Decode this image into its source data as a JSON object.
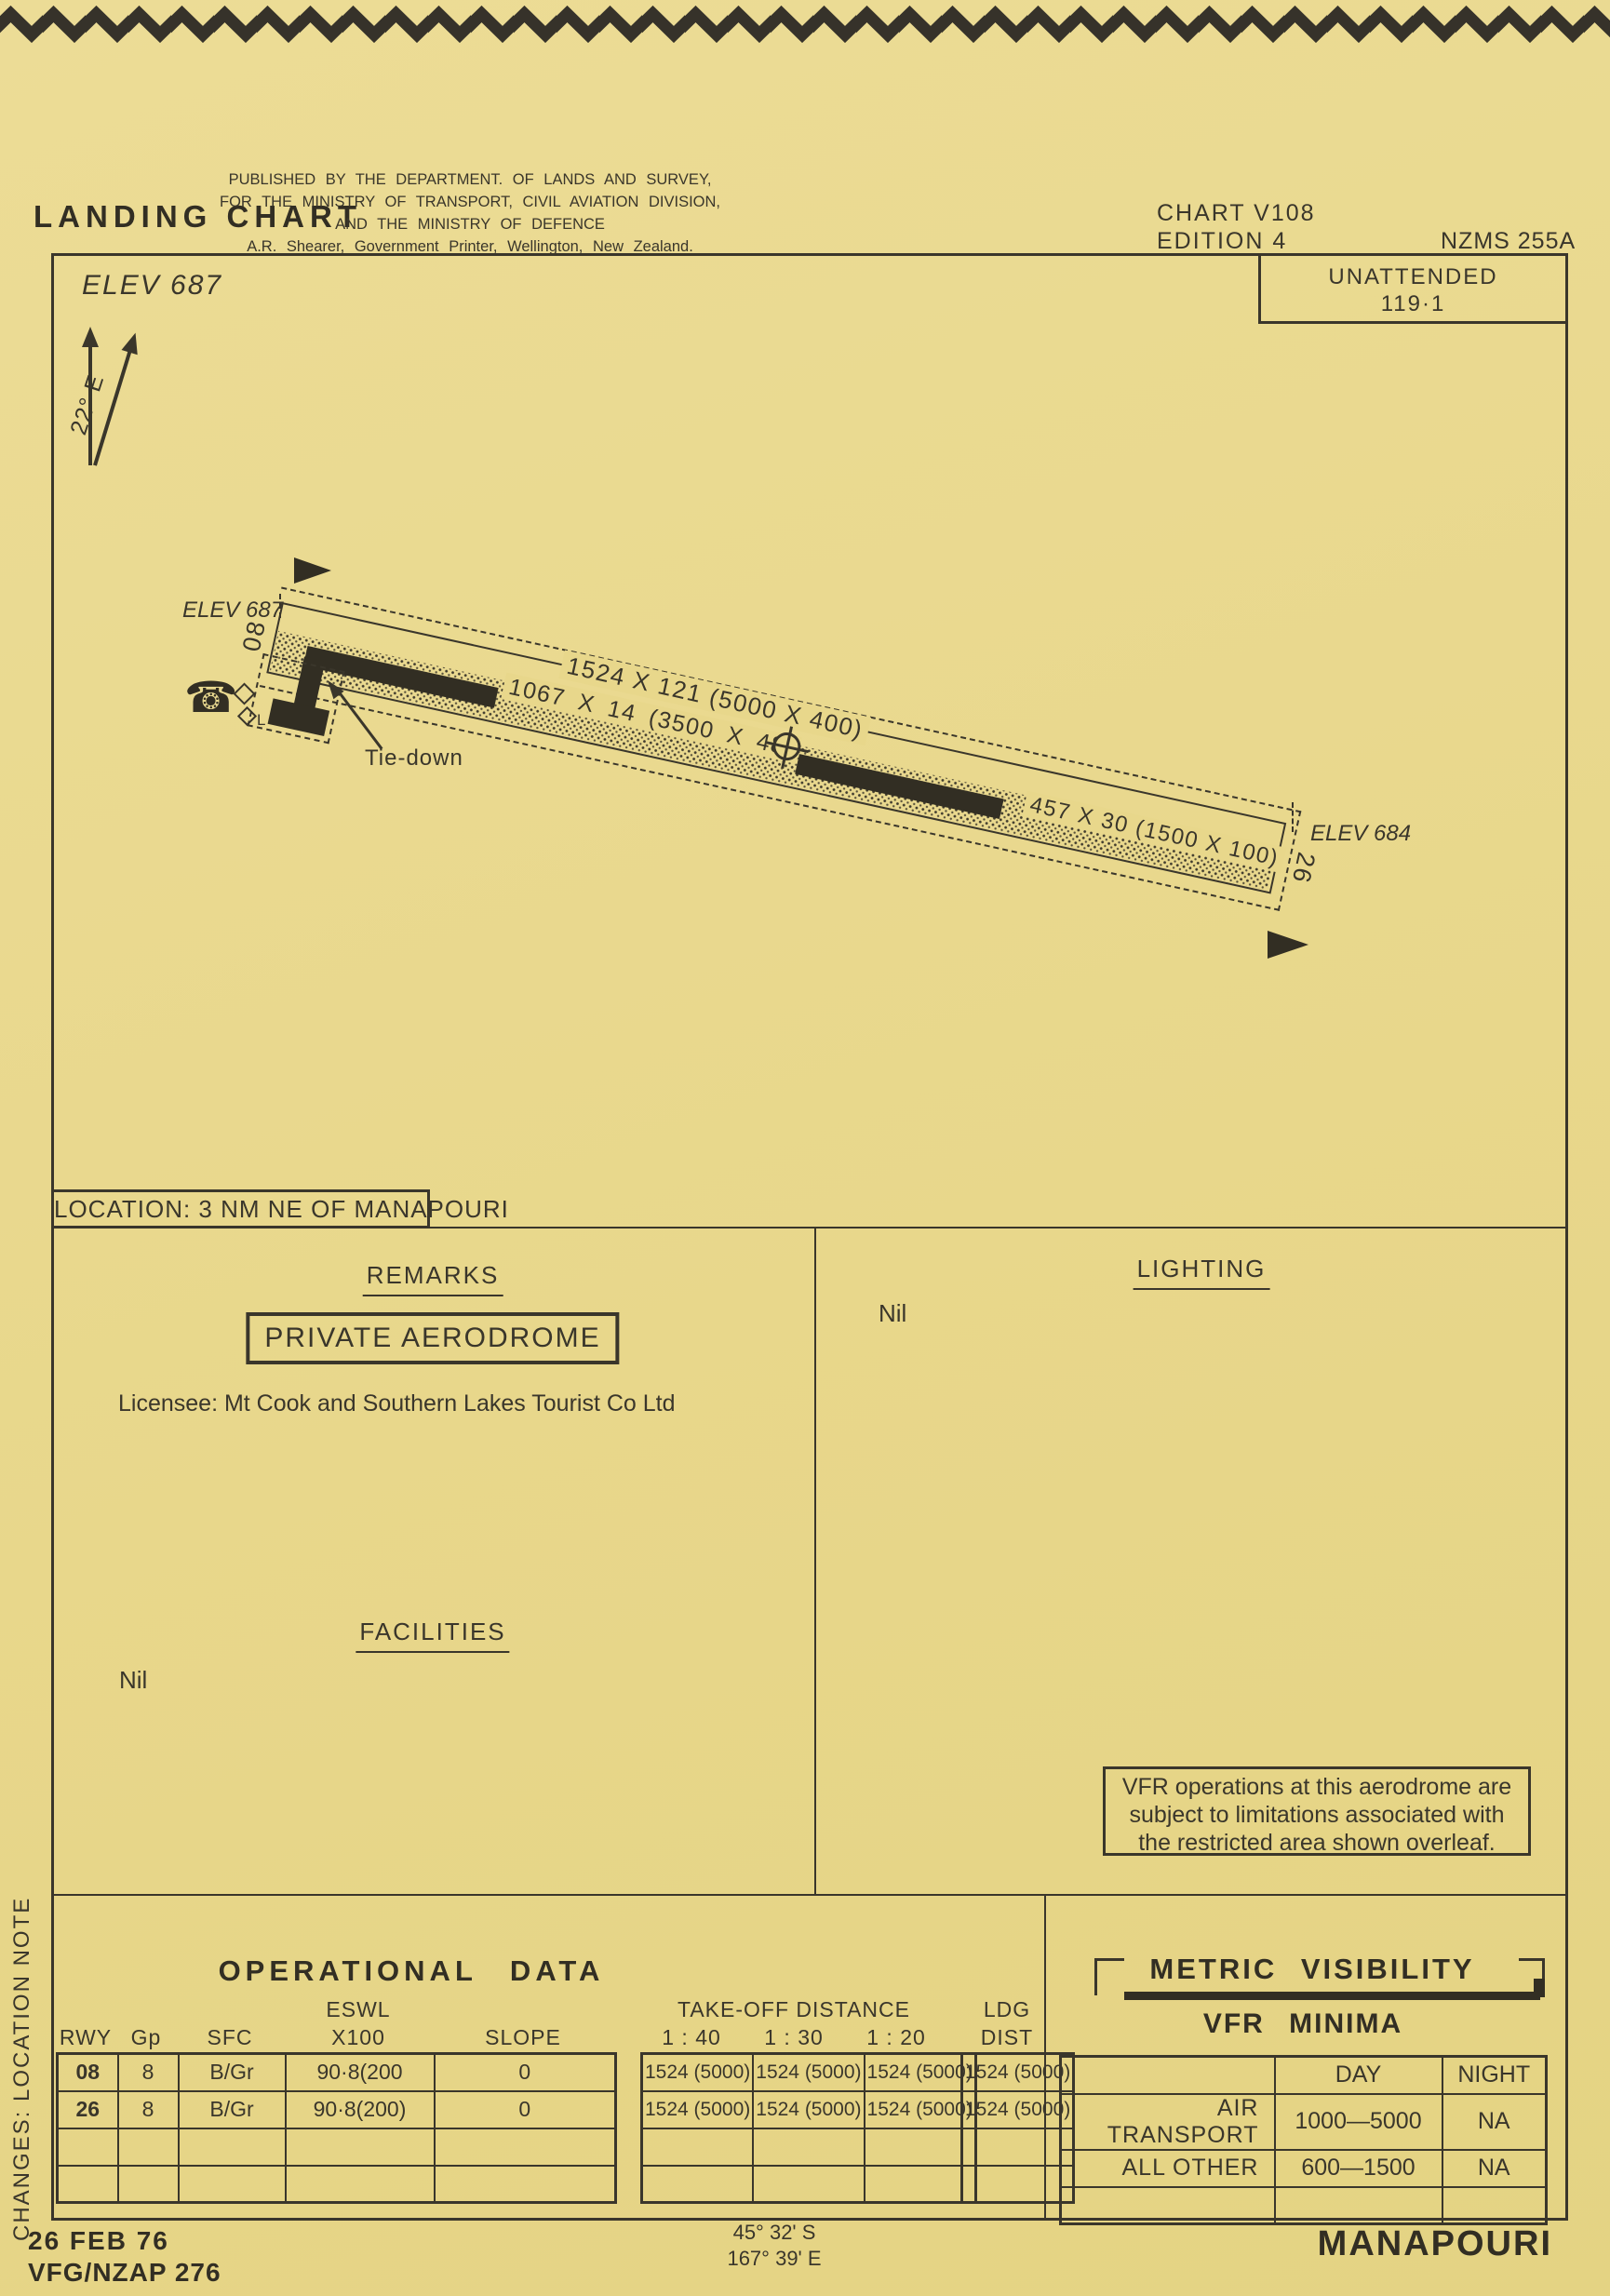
{
  "header": {
    "title": "LANDING CHART",
    "publisher_line1": "PUBLISHED BY THE DEPARTMENT. OF LANDS AND SURVEY,",
    "publisher_line2": "FOR THE MINISTRY OF TRANSPORT, CIVIL AVIATION DIVISION,",
    "publisher_line3": "AND THE MINISTRY OF DEFENCE",
    "publisher_line4": "A.R. Shearer, Government Printer, Wellington, New Zealand.",
    "chart_no": "CHART V108",
    "edition": "EDITION 4",
    "series": "NZMS 255A",
    "attendance": "UNATTENDED",
    "frequency": "119·1"
  },
  "diagram": {
    "field_elevation": "ELEV 687",
    "magnetic_variation": "22° E",
    "end_west": {
      "elevation": "ELEV 687",
      "designator": "08"
    },
    "end_east": {
      "elevation": "ELEV 684",
      "designator": "26"
    },
    "strip_dimensions": "1524 X 121 (5000 X 400)",
    "sealed_dimensions": "1067 X 14  (3500 X 48)",
    "grass_dimensions": "457 X 30 (1500 X 100)",
    "tie_down_label": "Tie-down",
    "boundary_marker_label": "L",
    "icons": {
      "telephone": "☎"
    }
  },
  "location": "LOCATION: 3 NM NE OF MANAPOURI",
  "remarks": {
    "heading": "REMARKS",
    "boxed_note": "PRIVATE AERODROME",
    "licensee": "Licensee: Mt Cook and Southern Lakes Tourist Co Ltd"
  },
  "lighting": {
    "heading": "LIGHTING",
    "value": "Nil"
  },
  "facilities": {
    "heading": "FACILITIES",
    "value": "Nil"
  },
  "vfr_note": {
    "line1": "VFR operations at this aerodrome are",
    "line2": "subject to limitations associated with",
    "line3": "the restricted area shown overleaf."
  },
  "operational_data": {
    "title": "OPERATIONAL DATA",
    "headers": {
      "rwy": "RWY",
      "gp": "Gp",
      "sfc": "SFC",
      "eswl_top": "ESWL",
      "eswl_bottom": "X100",
      "slope": "SLOPE",
      "takeoff": "TAKE-OFF DISTANCE",
      "ratio40": "1 : 40",
      "ratio30": "1 : 30",
      "ratio20": "1 : 20",
      "ldg_top": "LDG",
      "ldg_bottom": "DIST"
    },
    "rows": [
      {
        "rwy": "08",
        "gp": "8",
        "sfc": "B/Gr",
        "eswl": "90·8(200",
        "slope": "0",
        "to40": "1524 (5000)",
        "to30": "1524 (5000)",
        "to20": "1524 (5000)",
        "ldg": "1524 (5000)"
      },
      {
        "rwy": "26",
        "gp": "8",
        "sfc": "B/Gr",
        "eswl": "90·8(200)",
        "slope": "0",
        "to40": "1524 (5000)",
        "to30": "1524 (5000)",
        "to20": "1524 (5000)",
        "ldg": "1524 (5000)"
      }
    ]
  },
  "metric_visibility": {
    "title": "METRIC VISIBILITY",
    "subtitle": "VFR MINIMA",
    "col_day": "DAY",
    "col_night": "NIGHT",
    "rows": [
      {
        "category": "AIR TRANSPORT",
        "day": "1000—5000",
        "night": "NA"
      },
      {
        "category": "ALL OTHER",
        "day": "600—1500",
        "night": "NA"
      }
    ]
  },
  "footer": {
    "date": "26 FEB 76",
    "reference": "VFG/NZAP 276",
    "latitude": "45° 32' S",
    "longitude": "167° 39' E",
    "aerodrome_name": "MANAPOURI"
  },
  "side_note": "CHANGES:  LOCATION NOTE"
}
